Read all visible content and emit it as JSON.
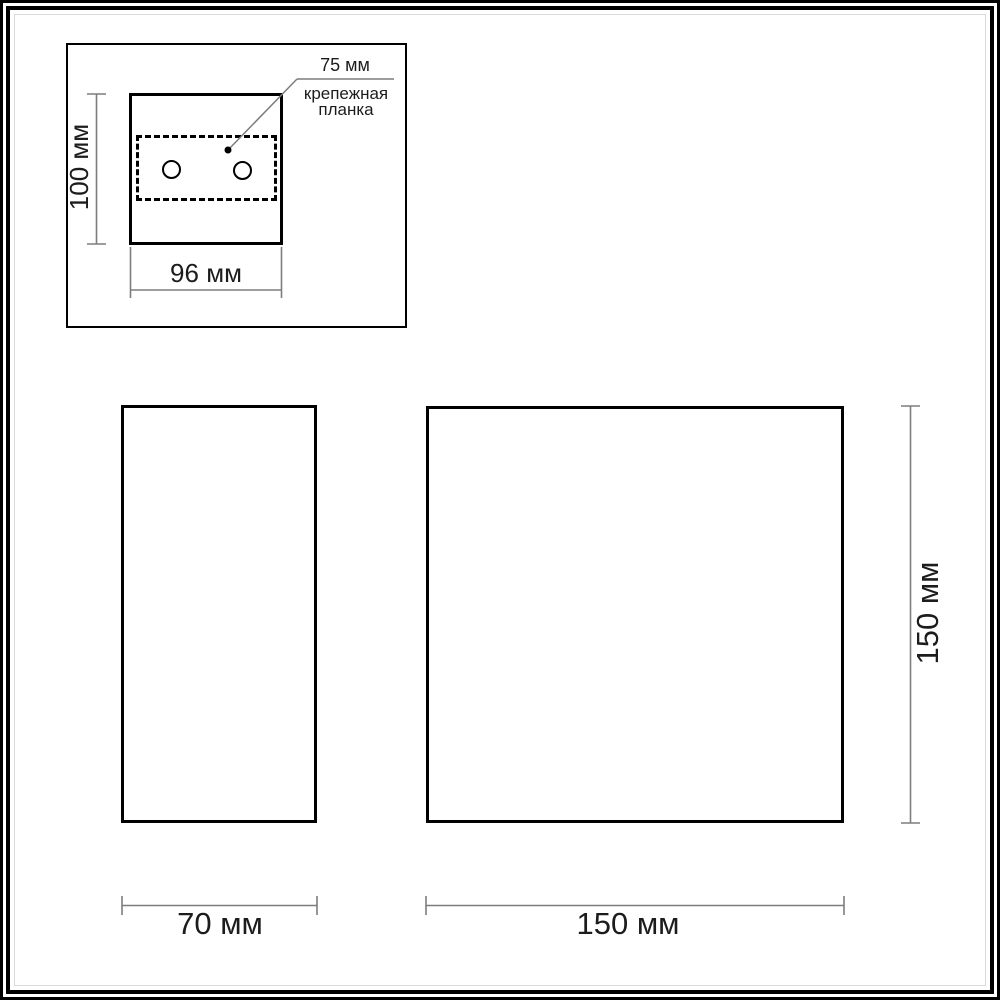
{
  "colors": {
    "outline": "#000000",
    "dimension_line": "#7d7d7d",
    "text": "#1c1c1c",
    "background": "#ffffff"
  },
  "views": {
    "mounting_detail": {
      "plate_offset_label": "75 мм",
      "plate_name_line1": "крепежная",
      "plate_name_line2": "планка",
      "height_label": "100 мм",
      "width_label": "96 мм"
    },
    "side_profile": {
      "width_label": "70 мм"
    },
    "front_face": {
      "width_label": "150 мм",
      "height_label": "150 мм"
    }
  }
}
